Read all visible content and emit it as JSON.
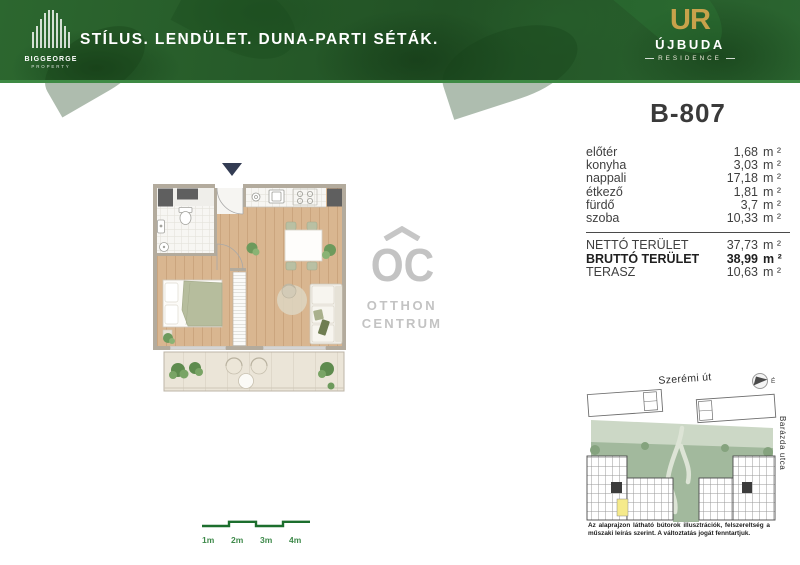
{
  "colors": {
    "header_green": "#2c672f",
    "header_underline": "#3e8a44",
    "brand_gold": "#c8a24b",
    "scale_green": "#1c6e2d",
    "watermark_gray": "#c3c3c3",
    "entrance_arrow_navy": "#333c53",
    "unit_highlight_yellow": "#f5ea8b"
  },
  "header": {
    "tagline": "STÍLUS. LENDÜLET. DUNA-PARTI SÉTÁK.",
    "brand_left_name": "BIGGEORGE",
    "brand_left_sub": "PROPERTY",
    "brand_right_monogram": "UR",
    "brand_right_name": "ÚJBUDA",
    "brand_right_sub": "RESIDENCE"
  },
  "unit": {
    "id": "B-807",
    "rooms": [
      {
        "label": "előtér",
        "value": "1,68",
        "unit": "m ²"
      },
      {
        "label": "konyha",
        "value": "3,03",
        "unit": "m ²"
      },
      {
        "label": "nappali",
        "value": "17,18",
        "unit": "m ²"
      },
      {
        "label": "étkező",
        "value": "1,81",
        "unit": "m ²"
      },
      {
        "label": "fürdő",
        "value": "3,7",
        "unit": "m ²"
      },
      {
        "label": "szoba",
        "value": "10,33",
        "unit": "m ²"
      }
    ],
    "totals": [
      {
        "label": "NETTÓ TERÜLET",
        "value": "37,73",
        "unit": "m ²"
      },
      {
        "label": "BRUTTÓ TERÜLET",
        "value": "38,99",
        "unit": "m ²"
      },
      {
        "label": "TERASZ",
        "value": "10,63",
        "unit": "m ²"
      }
    ]
  },
  "watermark": {
    "monogram": "OC",
    "line1": "OTTHON",
    "line2": "CENTRUM"
  },
  "scalebar": {
    "l1": "1m",
    "l2": "2m",
    "l3": "3m",
    "l4": "4m"
  },
  "siteplan": {
    "street_top": "Szerémi út",
    "street_right": "Barázda utca",
    "compass": "É",
    "disclaimer": "Az alaprajzon látható bútorok illusztrációk, felszereltség a műszaki leírás szerint. A változtatás jogát fenntartjuk."
  }
}
